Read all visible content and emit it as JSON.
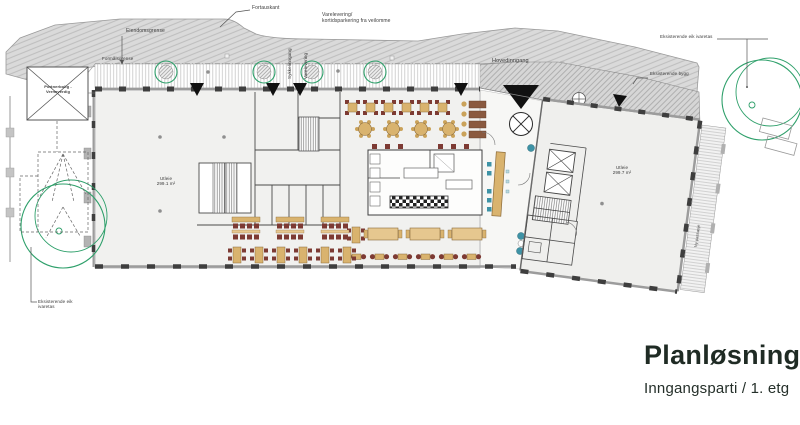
{
  "title_block": {
    "title": "Planløsning",
    "subtitle": "Inngangsparti / 1. etg"
  },
  "annotations": {
    "fortauskant": "Fortauskant",
    "varelevering_note": "Varelevering/\nkortidsparkering fra veilomme",
    "eiendomsgrense": "Eiendomsgrense",
    "formalsgrense": "Formålsgrense",
    "sykkelinngang": "Sykkelinngang",
    "varelevering": "Varelevering",
    "hovedinngang": "Hovedinngang",
    "eksisterende_eik_top": "Eksisterende eik ivaretas",
    "eksisterende_bygg": "Eksisterende bygg",
    "eksisterende_eik_bottom": "Eksisterende eik\nivaretas",
    "portnerbolig": "Portnerbolig -\nVerneverdig",
    "ny_passasje": "Ny passasje"
  },
  "rooms": {
    "utleie_left": "Utleie\n299.1 m²",
    "utleie_right": "Utleie\n299.7 m²"
  },
  "colors": {
    "tree_green": "#2fa06b",
    "furniture_tan": "#d9b36e",
    "chair_maroon": "#7d3a33",
    "accent_teal": "#3e93a6",
    "title_dark": "#1f2b24",
    "street_gray": "#dadada"
  }
}
